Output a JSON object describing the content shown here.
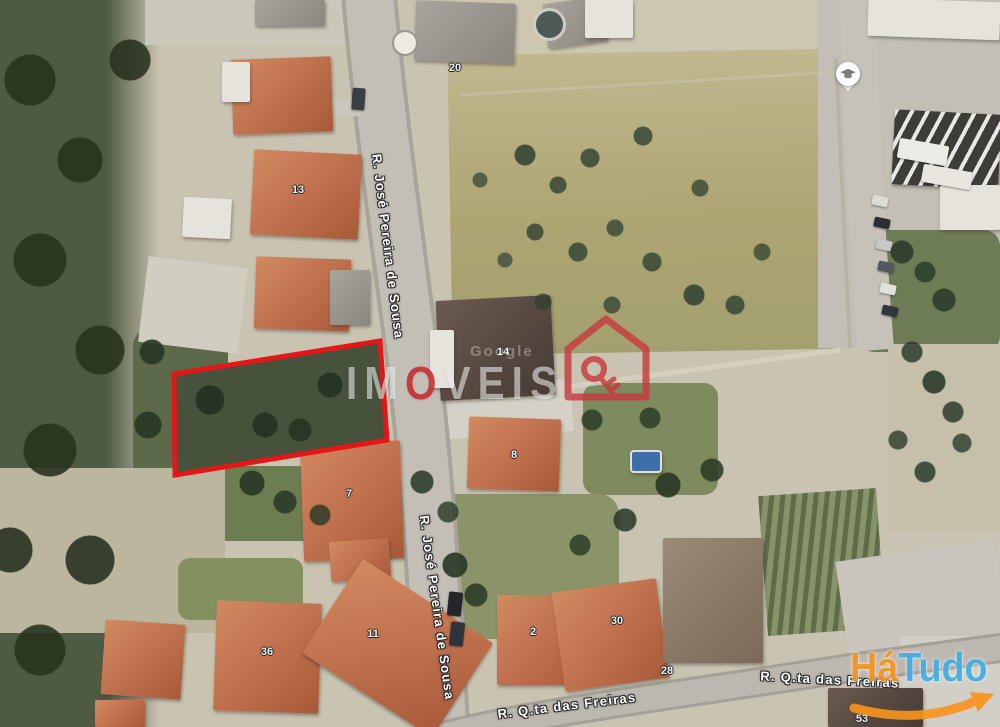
{
  "map": {
    "kind": "satellite-aerial-photo",
    "streets": {
      "sousa_upper": "R. José Pereira de Sousa",
      "sousa_lower": "R. José Pereira de Sousa",
      "freiras_left": "R. Q.ta das Freiras",
      "freiras_right": "R. Q.ta das Freiras"
    },
    "house_numbers": {
      "h20": "20",
      "h13": "13",
      "h14": "14",
      "h8": "8",
      "h7": "7",
      "h11": "11",
      "h36": "36",
      "h2": "2",
      "h30": "30",
      "h28": "28",
      "h53": "53"
    },
    "poi": {
      "school_marker": "graduation-cap-icon"
    },
    "plot": {
      "outline_color": "#e31717"
    }
  },
  "watermark": {
    "attribution": "Google",
    "brand_part1": "IM",
    "brand_accent_letter": "O",
    "brand_part2": "VEIS",
    "accent_color": "#cb1c22",
    "house_icon": "red-house-key-icon"
  },
  "logo": {
    "part1": "Há",
    "part2": "Tudo",
    "part1_color": "#F7941E",
    "part2_color": "#3FAFE4",
    "swoosh_color": "#F7941E"
  }
}
